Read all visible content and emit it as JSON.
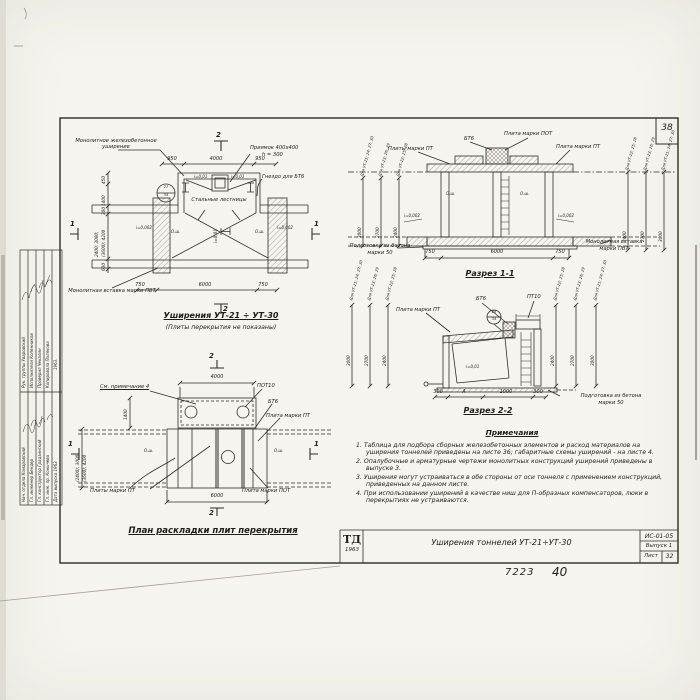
{
  "sheet": {
    "page_number": "38",
    "inventory_number": "7223",
    "handwritten_number": "40"
  },
  "title_block": {
    "logo": "ТД",
    "logo_year": "1963",
    "title": "Уширения тоннелей УТ-21÷УТ-30",
    "doc_code": "ИС-01-05",
    "issue": "Выпуск 1",
    "sheet_label": "Лист",
    "sheet_number": "32"
  },
  "side_stamp": {
    "group1": [
      {
        "role": "Рук. группы",
        "name": "Уваровский"
      },
      {
        "role": "Исполнители",
        "name": "Копенников"
      },
      {
        "role": "Проверил",
        "name": "Чекалин"
      },
      {
        "role": "Копировала",
        "name": "Полякова"
      }
    ],
    "group1_year": "1963.",
    "group2": [
      {
        "role": "Нач. отдела",
        "name": "Комаровский"
      },
      {
        "role": "Гл. инженер",
        "name": "Бендер"
      },
      {
        "role": "Гл. конструктор",
        "name": "Градзинский"
      },
      {
        "role": "Гл. инж. пр.",
        "name": "Конычева"
      },
      {
        "role": "Дата выпуска",
        "name": "1963"
      }
    ]
  },
  "plan_top": {
    "title": "Уширения УТ-21 ÷ УТ-30",
    "subtitle": "(Плиты перекрытия не показаны)",
    "labels": {
      "widening": "Монолитное железобетонное уширение",
      "pit": "Приямок 400х400",
      "pit_h": "h = 300",
      "socket": "Гнездо для БТ6",
      "ladders": "Стальные лестницы",
      "insert": "Монолитная вставка марки ПВТ"
    },
    "slope_center": "i=0,01",
    "slope_wall": "i=0,002",
    "axis_mark": "О.ш.",
    "detail_top": "27",
    "detail_bottom": "34",
    "dims": {
      "top": [
        "950",
        "4000",
        "950"
      ],
      "bottom": [
        "750",
        "6000",
        "750"
      ],
      "left": [
        "450",
        "1400",
        "300",
        "600"
      ],
      "left_multi_1": "2400; 3000;",
      "left_multi_2": "(3600); 4200"
    },
    "flag_1": "1",
    "flag_2": "2"
  },
  "section_1": {
    "title": "Разрез 1-1",
    "labels": {
      "plity_pt": "Плиты марки ПТ",
      "bt6": "БТ6",
      "plita_pot": "Плита марки ПОТ",
      "plita_pt": "Плита марки ПТ",
      "podgotovka_1": "Подготовка из бетона",
      "podgotovka_2": "марки 50",
      "vstavka_1": "Монолитная вставка",
      "vstavka_2": "марки ПВТ",
      "axis_mark": "О.ш.",
      "slope": "i=0,002"
    },
    "dim_headers": [
      "Для УТ-21; 24; 27; 30",
      "Для УТ-23; 26; 29",
      "Для УТ-22; 25; 28"
    ],
    "dim_values": [
      "3000",
      "2700",
      "2400"
    ],
    "dim_headers_right": [
      "Для УТ-22; 25; 28",
      "Для УТ-23; 26; 29",
      "Для УТ-21; 24; 27; 30"
    ],
    "dim_values_right": [
      "2400",
      "2700",
      "3000"
    ],
    "dims_bottom": [
      "750",
      "6000",
      "750"
    ]
  },
  "section_2": {
    "title": "Разрез 2-2",
    "labels": {
      "plita_pt": "Плита марки ПТ",
      "bt6": "БТ6",
      "pt10": "ПТ10",
      "slope": "i=0,01",
      "podgotovka_1": "Подготовка из бетона",
      "podgotovka_2": "марки 50"
    },
    "detail_top": "28",
    "detail_bottom": "34",
    "dim_headers_left": [
      "Для УТ-21; 24; 27; 30",
      "Для УТ-23; 26; 29",
      "Для УТ-22; 25; 28"
    ],
    "dim_values_left": [
      "3000",
      "2700",
      "2400"
    ],
    "dim_headers_right": [
      "Для УТ-22; 25; 28",
      "Для УТ-23; 26; 29",
      "Для УТ-21; 24; 27; 30"
    ],
    "dim_values_right": [
      "2400",
      "2700",
      "3000"
    ],
    "dims_bottom": [
      "300",
      "А",
      "1000",
      "300"
    ]
  },
  "plan_bottom": {
    "title": "План раскладки плит перекрытия",
    "labels": {
      "see_note": "См. примечание 4",
      "pot10": "ПОТ10",
      "bt6": "БТ6",
      "plita_pt": "Плита марки ПТ",
      "plity_pt": "Плиты марки ПТ",
      "plita_pot": "Плита марки ПОТ",
      "axis_mark": "О.ш."
    },
    "dims": {
      "top": "4000",
      "bottom": "6000",
      "left_top": "1400",
      "left_multi_1": "(2400); 3000;",
      "left_multi_2": "(3600); 4200"
    },
    "flag_1": "1",
    "flag_2": "2"
  },
  "notes": {
    "title": "Примечания",
    "items": [
      "1. Таблица для подбора сборных железобетонных элементов и расход материалов на уширения тоннелей приведены на листе 36; габаритные схемы уширений - на листе 4.",
      "2. Опалубочные и арматурные чертежи монолитных конструкций уширений приведены в выпуске 3.",
      "3. Уширения могут устраиваться в обе стороны от оси тоннеля с применением конструкций, приведенных на данном листе.",
      "4. При использовании уширений в качестве ниш для П-образных компенсаторов, люки в перекрытиях не устраиваются."
    ]
  }
}
